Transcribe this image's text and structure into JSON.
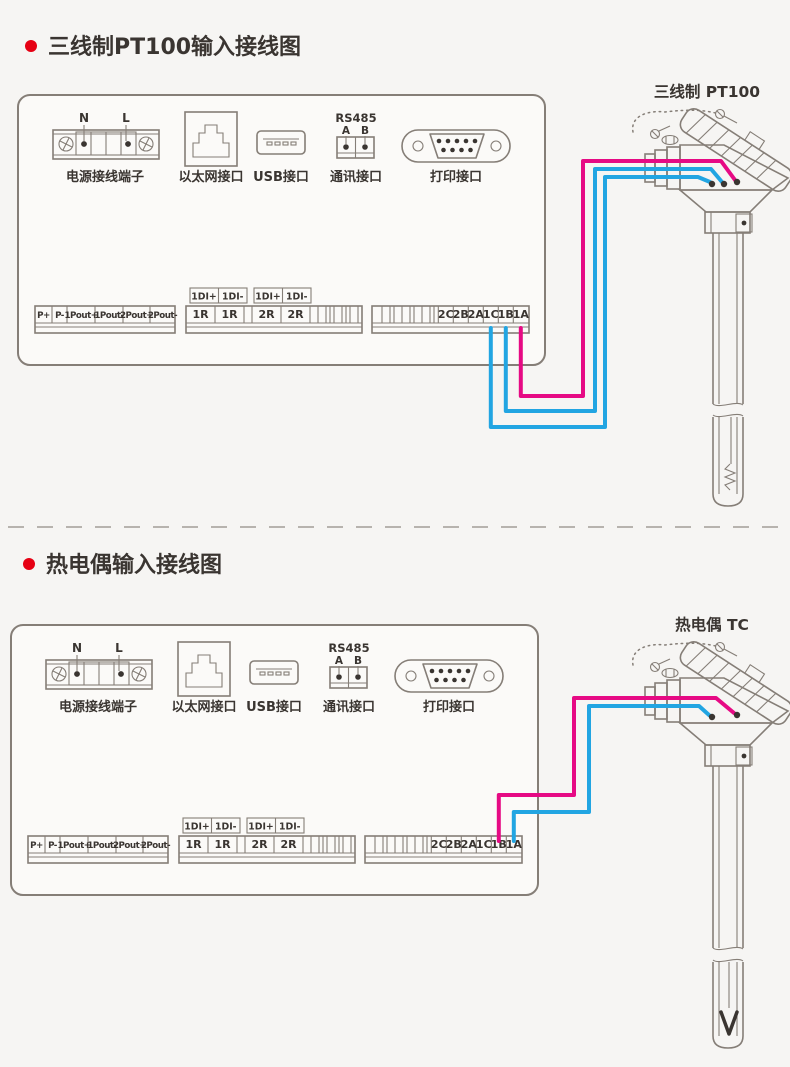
{
  "colors": {
    "bg": "#f6f5f3",
    "panel": "#fbfaf8",
    "line": "#857e77",
    "ink": "#3a3531",
    "wire_hot": "#e60a84",
    "wire_cold": "#22a5e2",
    "bullet": "#e60013",
    "divider": "#b7b3ae"
  },
  "sections": [
    {
      "title": "三线制PT100输入接线图",
      "sensor_label": "三线制 PT100"
    },
    {
      "title": "热电偶输入接线图",
      "sensor_label": "热电偶 TC"
    }
  ],
  "panel": {
    "power": {
      "n": "N",
      "l": "L",
      "caption": "电源接线端子"
    },
    "ethernet": {
      "caption": "以太网接口"
    },
    "usb": {
      "caption": "USB接口"
    },
    "rs485": {
      "title": "RS485",
      "a": "A",
      "b": "B",
      "caption": "通讯接口"
    },
    "printer": {
      "caption": "打印接口"
    },
    "strip_power": {
      "cells": [
        "P+",
        "P-",
        "1Pout+",
        "1Pout-",
        "2Pout+",
        "2Pout-"
      ]
    },
    "strip_di": {
      "top_labels": [
        "1DI+",
        "1DI-",
        "1DI+",
        "1DI-"
      ],
      "cells": [
        "1R",
        "1R",
        "2R",
        "2R"
      ]
    },
    "strip_input": {
      "cells": [
        "2C",
        "2B",
        "2A",
        "1C",
        "1B",
        "1A"
      ]
    }
  }
}
